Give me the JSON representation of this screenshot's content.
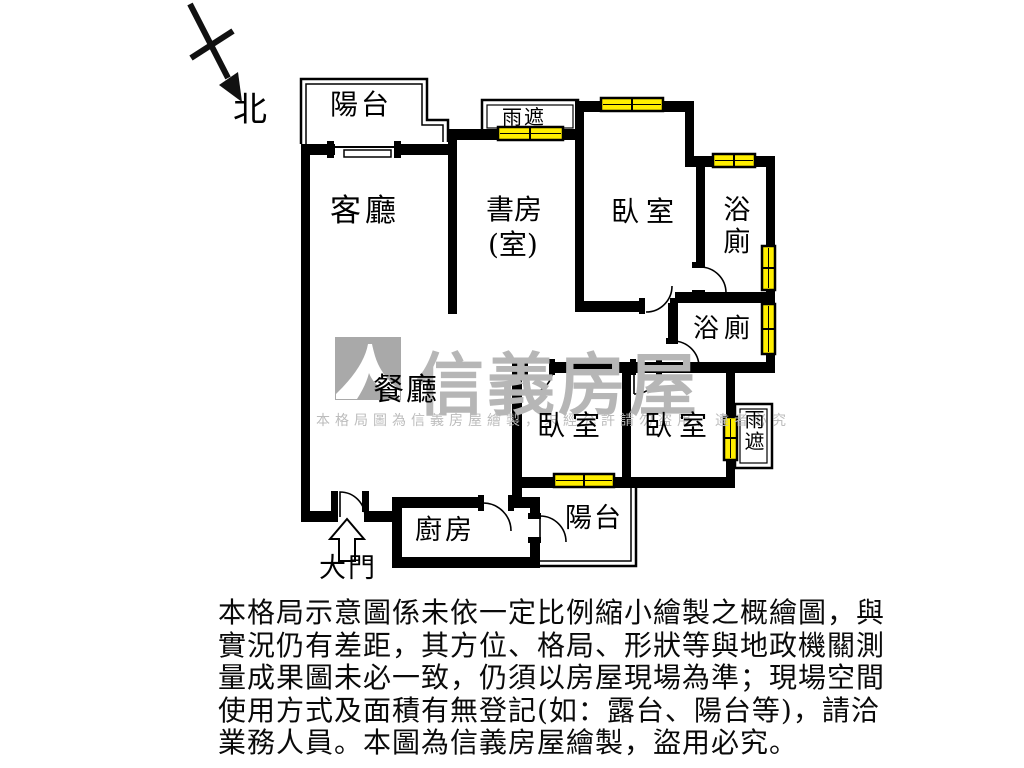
{
  "plan": {
    "north_label": "北",
    "entrance_label": "大門",
    "rooms": {
      "balcony_top": "陽台",
      "living_room": "客廳",
      "study_line1": "書房",
      "study_line2": "(室)",
      "bedroom_top": "臥室",
      "bathroom_top": "浴廁",
      "bathroom_mid": "浴廁",
      "dining_room": "餐廳",
      "bedroom_bottom_left": "臥室",
      "bedroom_bottom_right": "臥室",
      "kitchen": "廚房",
      "balcony_bottom": "陽台",
      "rain_shelter_top": "雨遮",
      "rain_shelter_right": "雨遮"
    }
  },
  "watermark": {
    "brand": "信義房屋",
    "notice": "本格局圖為信義房屋繪製，未經允許請勿盜用，違者必究"
  },
  "disclaimer": {
    "lines": [
      "本格局示意圖係未依一定比例縮小繪製之概繪圖，與",
      "實況仍有差距，其方位、格局、形狀等與地政機關測",
      "量成果圖未必一致，仍須以房屋現場為準；現場空間",
      "使用方式及面積有無登記(如：露台、陽台等)，請洽",
      "業務人員。本圖為信義房屋繪製，盜用必究。"
    ]
  },
  "colors": {
    "wall": "#000000",
    "window_fill": "#ffee00",
    "watermark_gray": "#b6b6b6"
  }
}
